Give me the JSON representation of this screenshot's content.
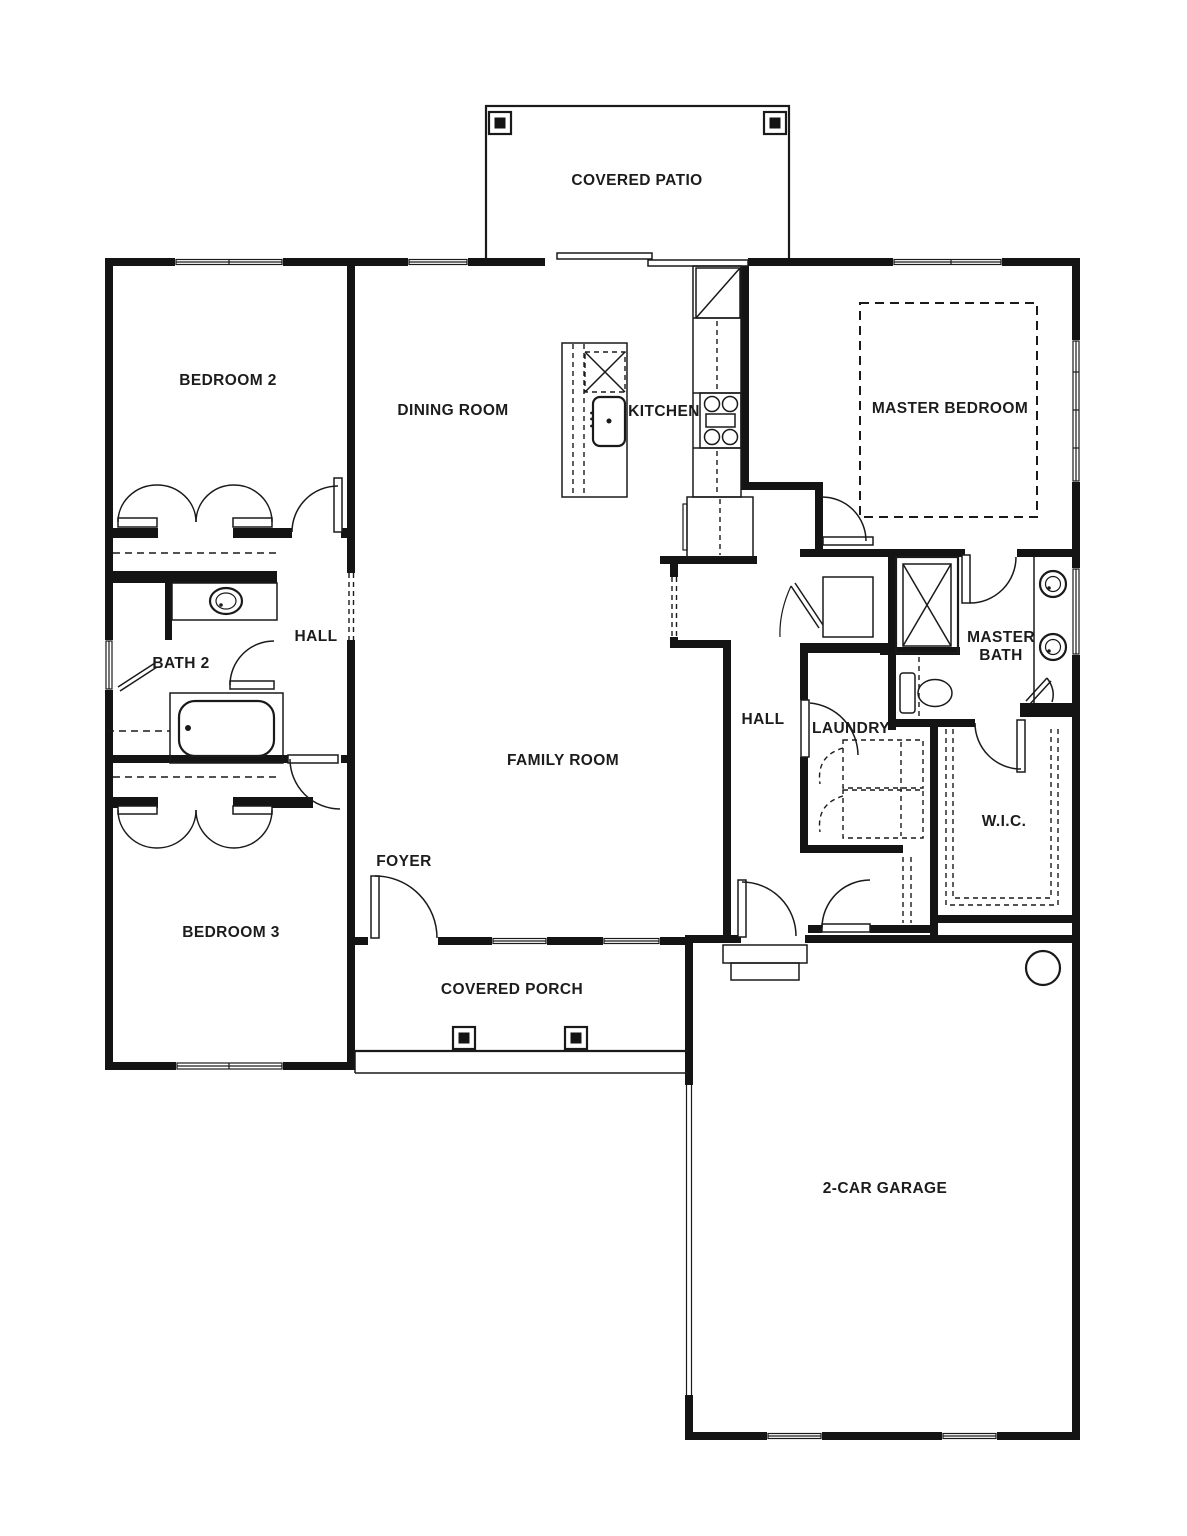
{
  "plan": {
    "title": "single-story house floor plan",
    "rooms": {
      "covered_patio": "COVERED PATIO",
      "bedroom2": "B",
      "bedroom2_label": "BEDROOM 2",
      "dining_room": "DINING ROOM",
      "kitchen": "KITCHEN",
      "master_bedroom": "MASTER BEDROOM",
      "hall_left": "HALL",
      "bath2": "BATH 2",
      "family_room": "FAMILY ROOM",
      "hall_right": "HALL",
      "laundry": "LAUNDRY",
      "master_bath_line1": "MASTER",
      "master_bath_line2": "BATH",
      "wic": "W.I.C.",
      "bedroom3": "BEDROOM 3",
      "foyer": "FOYER",
      "covered_porch": "COVERED PORCH",
      "garage": "2-CAR GARAGE"
    },
    "fixtures": [
      "refrigerator",
      "range-cooktop",
      "pantry-cabinet",
      "island-sink",
      "island-dishwasher",
      "bath2-sink",
      "bathtub",
      "shower",
      "toilet",
      "double-vanity-sinks",
      "washer-dryer",
      "water-heater",
      "garage-steps",
      "patio-posts",
      "porch-posts",
      "tray-ceiling"
    ],
    "colors": {
      "wall": "#141414",
      "line": "#1a1a1a",
      "background": "#ffffff",
      "text": "#1c1c1c"
    }
  }
}
